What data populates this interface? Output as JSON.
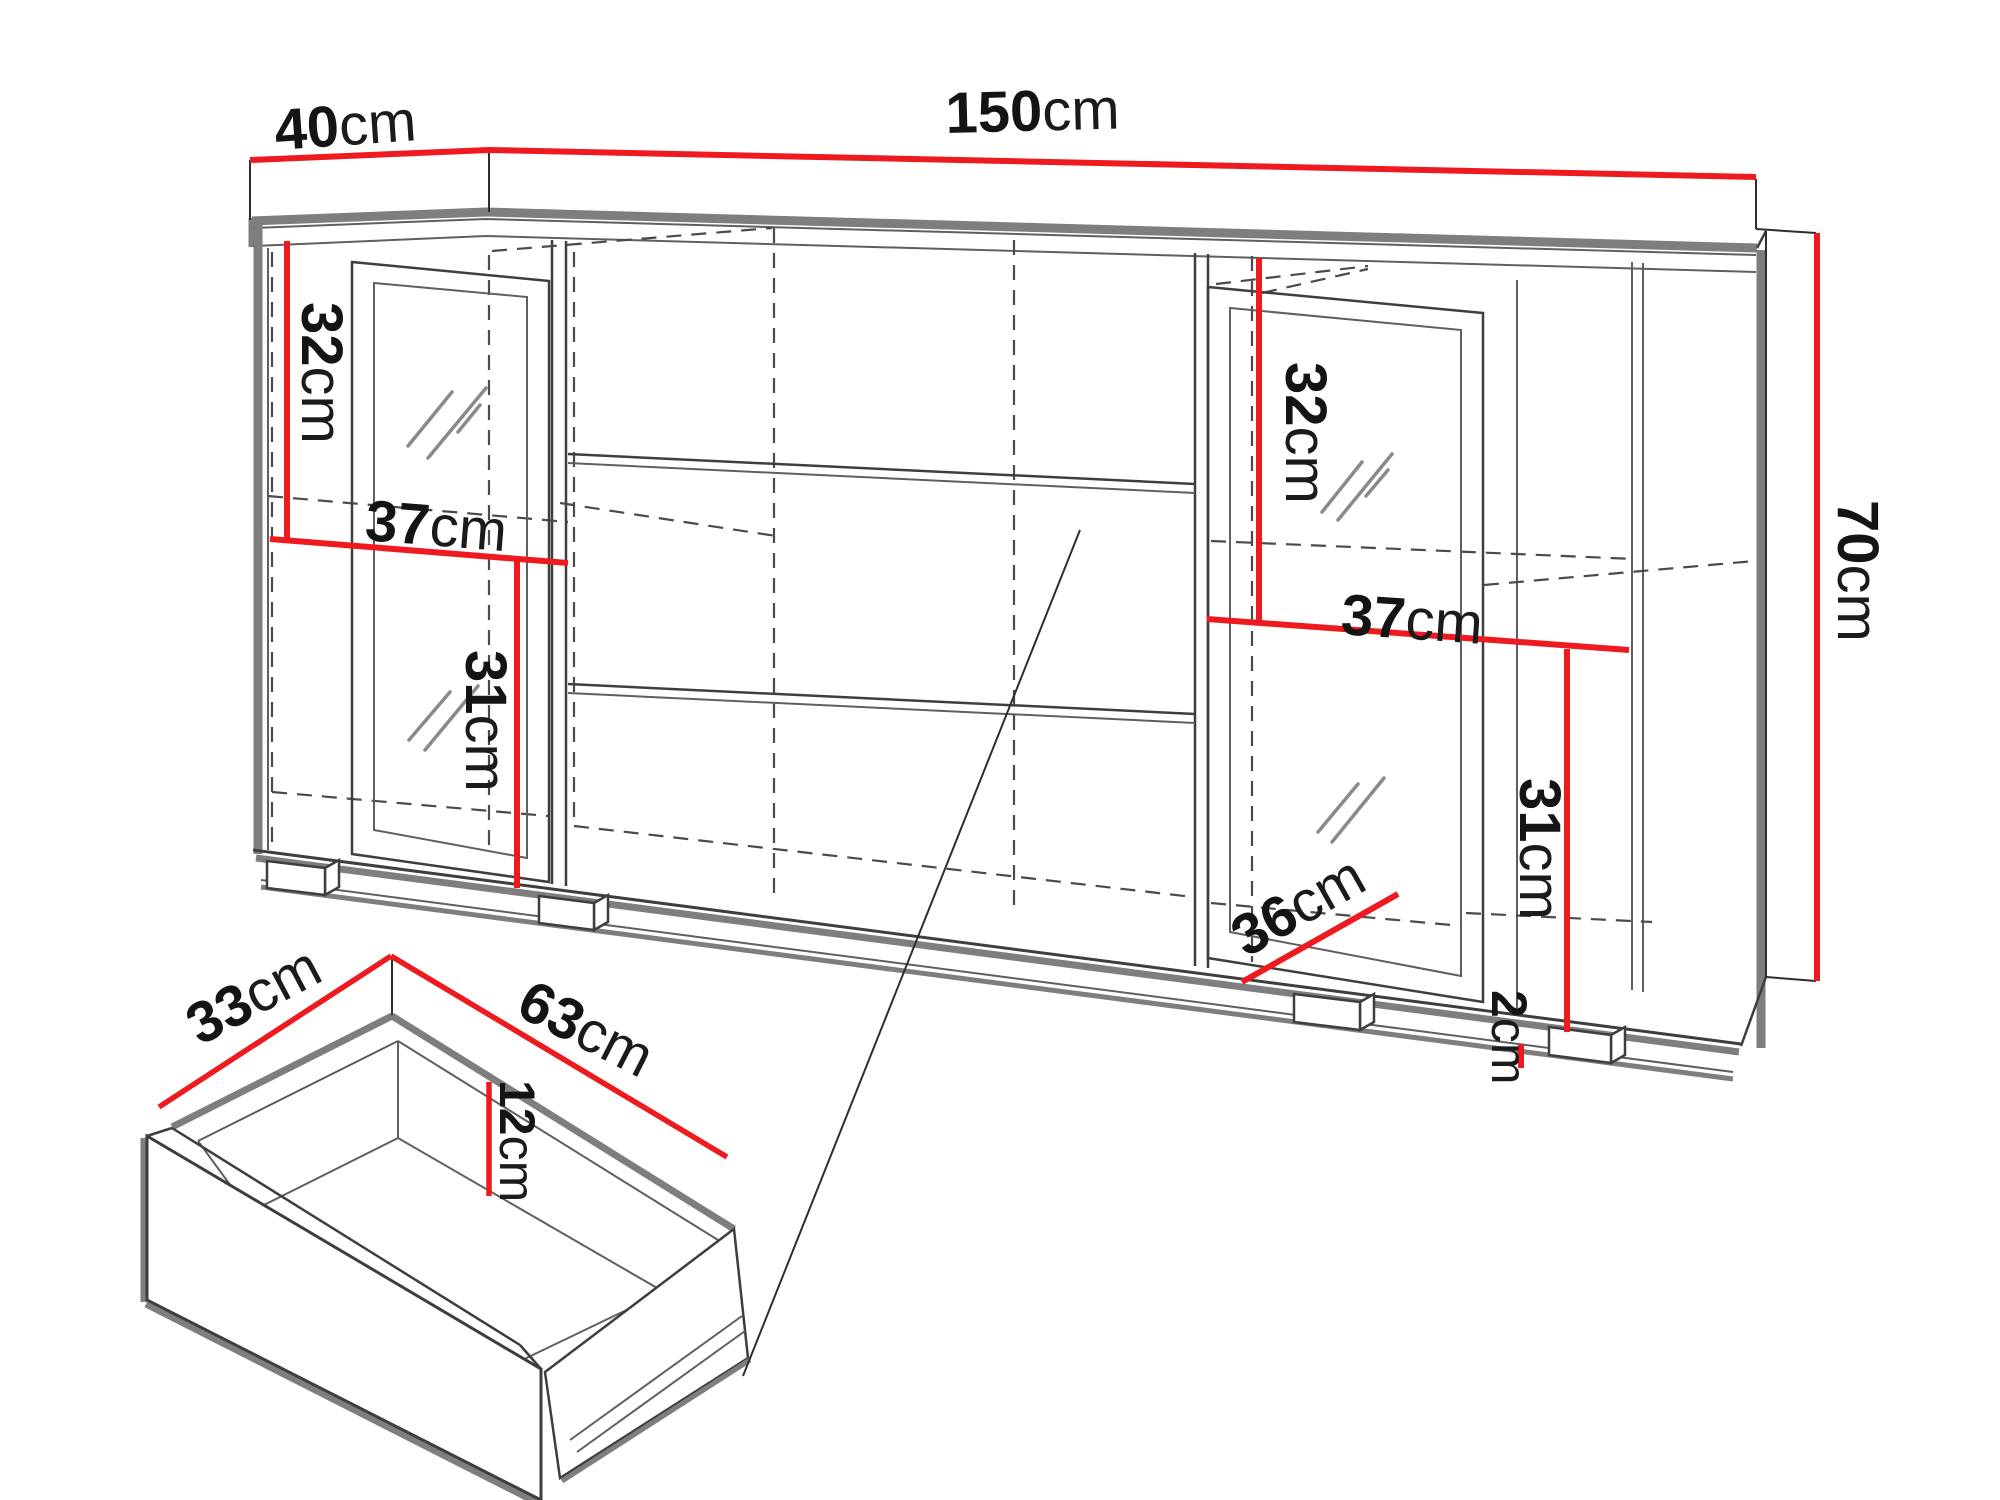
{
  "diagram": {
    "type": "furniture-dimension-drawing",
    "subject": "sideboard cabinet with two glass doors, open shelves and drawer detail",
    "accent_color": "#ed1b1f",
    "outline_gray": "#7e7e7e",
    "line_color": "#3e3e3e",
    "background": "#ffffff"
  },
  "dims": {
    "top_depth": {
      "value": "40",
      "unit": "cm"
    },
    "top_width": {
      "value": "150",
      "unit": "cm"
    },
    "side_height": {
      "value": "70",
      "unit": "cm"
    },
    "left_upper_height": {
      "value": "32",
      "unit": "cm"
    },
    "left_shelf_width": {
      "value": "37",
      "unit": "cm"
    },
    "left_lower_height": {
      "value": "31",
      "unit": "cm"
    },
    "right_upper_height": {
      "value": "32",
      "unit": "cm"
    },
    "right_shelf_width": {
      "value": "37",
      "unit": "cm"
    },
    "right_inner_depth": {
      "value": "36",
      "unit": "cm"
    },
    "right_lower_height": {
      "value": "31",
      "unit": "cm"
    },
    "plinth_height": {
      "value": "2",
      "unit": "cm"
    },
    "drawer_depth": {
      "value": "33",
      "unit": "cm"
    },
    "drawer_width": {
      "value": "63",
      "unit": "cm"
    },
    "drawer_inner_height": {
      "value": "12",
      "unit": "cm"
    }
  }
}
